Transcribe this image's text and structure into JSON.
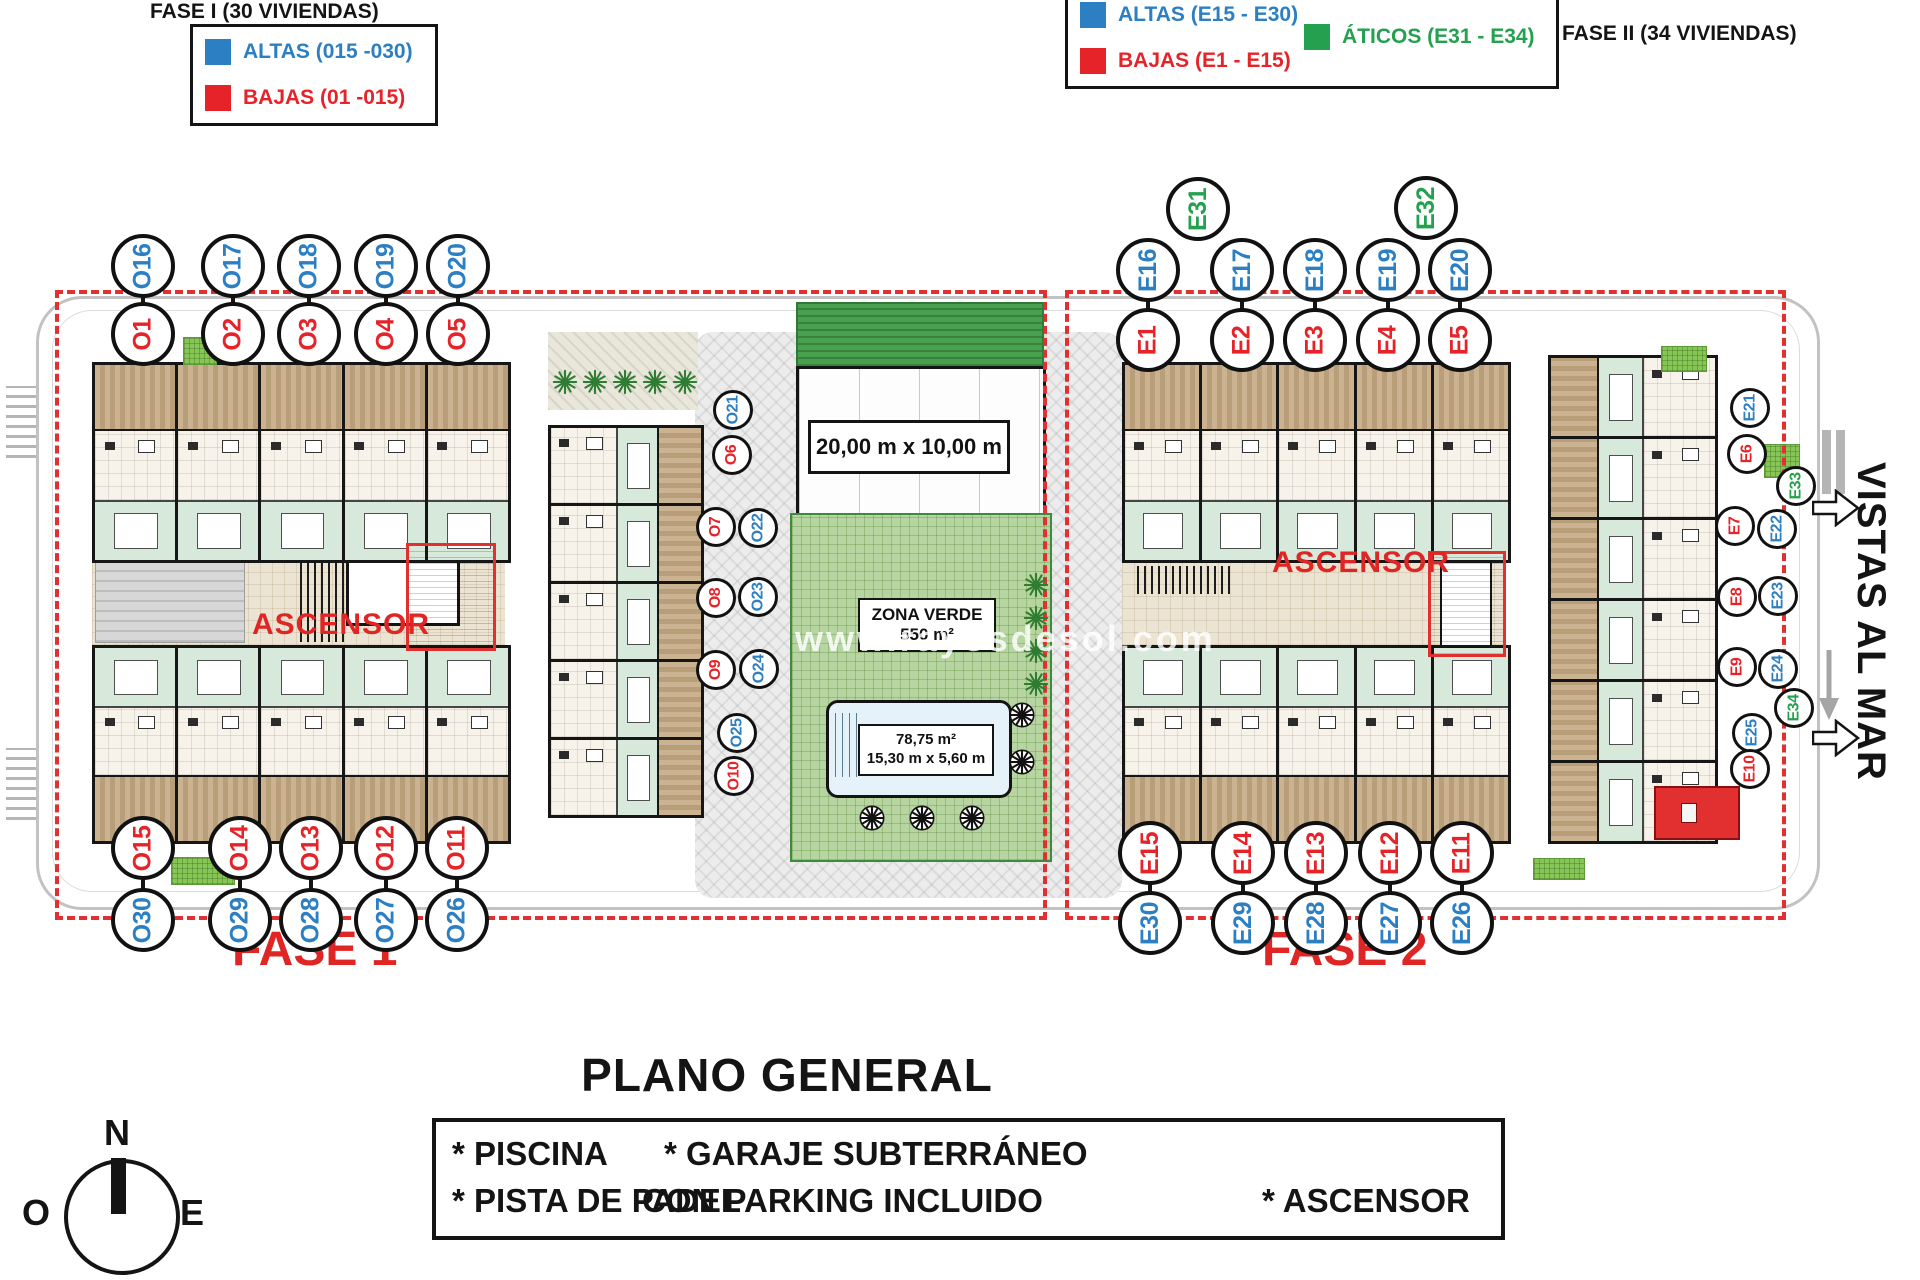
{
  "legend_fase1": {
    "title": "FASE I (30 VIVIENDAS)",
    "items": [
      {
        "label": "ALTAS (015 -030)",
        "color": "blue"
      },
      {
        "label": "BAJAS (01 -015)",
        "color": "red"
      }
    ]
  },
  "legend_fase2": {
    "title": "FASE II (34 VIVIENDAS)",
    "items": [
      {
        "label": "ALTAS (E15 - E30)",
        "color": "blue"
      },
      {
        "label": "BAJAS (E1 - E15)",
        "color": "red"
      },
      {
        "label": "ÁTICOS (E31 - E34)",
        "color": "green"
      }
    ]
  },
  "labels": {
    "ascensor": "ASCENSOR",
    "fase1": "FASE 1",
    "fase2": "FASE 2",
    "vistas_al_mar": "VISTAS AL MAR",
    "watermark": "www.rayosdesol.com",
    "title": "PLANO GENERAL"
  },
  "central": {
    "padel_dims": "20,00 m x 10,00 m",
    "zona_verde_title": "ZONA VERDE",
    "zona_verde_area": "550 m²",
    "pool_area": "78,75 m²",
    "pool_dims": "15,30 m x 5,60 m"
  },
  "amenities": {
    "col1": [
      "* PISCINA",
      "* PISTA DE PADEL"
    ],
    "col2": [
      "* GARAJE SUBTERRÁNEO",
      "CON PARKING INCLUIDO"
    ],
    "col3": [
      "* ASCENSOR"
    ]
  },
  "compass": {
    "north": "N",
    "west": "O",
    "east": "E"
  },
  "colors": {
    "blue": "#2b7fc2",
    "red": "#e62329",
    "green": "#23a14e"
  },
  "unit_labels": {
    "f1_top_blue": [
      [
        "O16",
        "blue"
      ],
      [
        "O17",
        "blue"
      ],
      [
        "O18",
        "blue"
      ],
      [
        "O19",
        "blue"
      ],
      [
        "O20",
        "blue"
      ]
    ],
    "f1_top_red": [
      [
        "O1",
        "red"
      ],
      [
        "O2",
        "red"
      ],
      [
        "O3",
        "red"
      ],
      [
        "O4",
        "red"
      ],
      [
        "O5",
        "red"
      ]
    ],
    "f1_mid": [
      [
        "O21",
        "blue"
      ],
      [
        "O6",
        "red"
      ],
      [
        "O7",
        "red"
      ],
      [
        "O22",
        "blue"
      ],
      [
        "O8",
        "red"
      ],
      [
        "O23",
        "blue"
      ],
      [
        "O9",
        "red"
      ],
      [
        "O24",
        "blue"
      ],
      [
        "O25",
        "blue"
      ],
      [
        "O10",
        "red"
      ]
    ],
    "f1_bottom_red": [
      [
        "O15",
        "red"
      ],
      [
        "O14",
        "red"
      ],
      [
        "O13",
        "red"
      ],
      [
        "O12",
        "red"
      ],
      [
        "O11",
        "red"
      ]
    ],
    "f1_bottom_blue": [
      [
        "O30",
        "blue"
      ],
      [
        "O29",
        "blue"
      ],
      [
        "O28",
        "blue"
      ],
      [
        "O27",
        "blue"
      ],
      [
        "O26",
        "blue"
      ]
    ],
    "f2_top_green": [
      [
        "E31",
        "green"
      ],
      [
        "E32",
        "green"
      ]
    ],
    "f2_top_blue": [
      [
        "E16",
        "blue"
      ],
      [
        "E17",
        "blue"
      ],
      [
        "E18",
        "blue"
      ],
      [
        "E19",
        "blue"
      ],
      [
        "E20",
        "blue"
      ]
    ],
    "f2_top_red": [
      [
        "E1",
        "red"
      ],
      [
        "E2",
        "red"
      ],
      [
        "E3",
        "red"
      ],
      [
        "E4",
        "red"
      ],
      [
        "E5",
        "red"
      ]
    ],
    "f2_right": [
      [
        "E21",
        "blue"
      ],
      [
        "E6",
        "red"
      ],
      [
        "E33",
        "green"
      ],
      [
        "E7",
        "red"
      ],
      [
        "E22",
        "blue"
      ],
      [
        "E8",
        "red"
      ],
      [
        "E23",
        "blue"
      ],
      [
        "E9",
        "red"
      ],
      [
        "E24",
        "blue"
      ],
      [
        "E34",
        "green"
      ],
      [
        "E25",
        "blue"
      ],
      [
        "E10",
        "red"
      ]
    ],
    "f2_bottom_red": [
      [
        "E15",
        "red"
      ],
      [
        "E14",
        "red"
      ],
      [
        "E13",
        "red"
      ],
      [
        "E12",
        "red"
      ],
      [
        "E11",
        "red"
      ]
    ],
    "f2_bottom_blue": [
      [
        "E30",
        "blue"
      ],
      [
        "E29",
        "blue"
      ],
      [
        "E28",
        "blue"
      ],
      [
        "E27",
        "blue"
      ],
      [
        "E26",
        "blue"
      ]
    ]
  }
}
